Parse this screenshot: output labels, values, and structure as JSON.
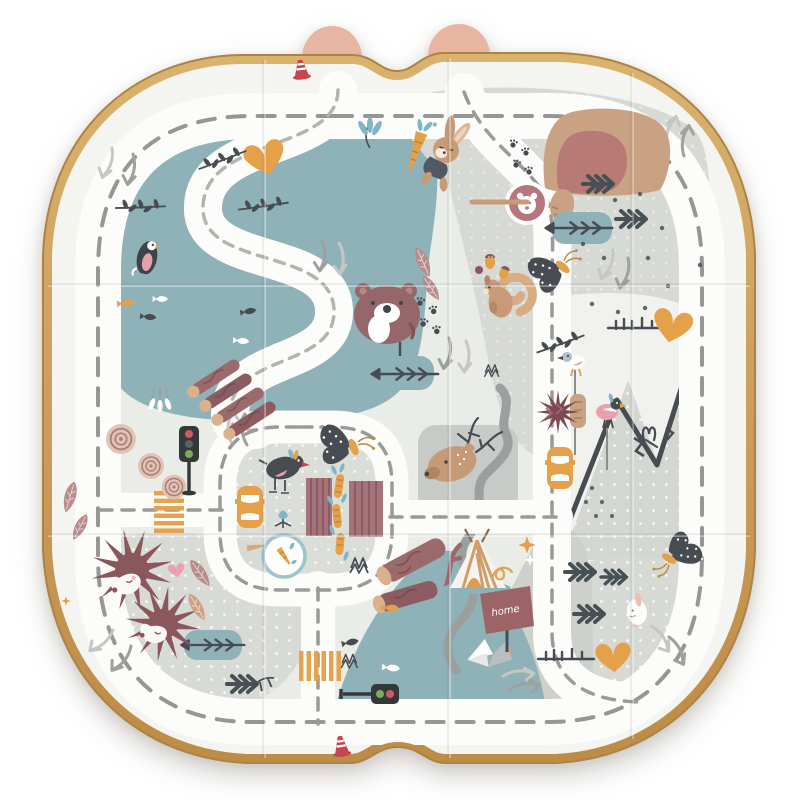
{
  "scene": {
    "type": "product-photo",
    "subject": "foldable children's play mat printed with a woodland road-map design",
    "background_color": "#ffffff"
  },
  "mat": {
    "border_color": "#c99e58",
    "surface_color": "#f4f5f1",
    "tab_color": "#e8b5a2",
    "tab_count": 2,
    "fold_creases": {
      "vertical_x": [
        262,
        447,
        630
      ],
      "horizontal_y": [
        283,
        533
      ]
    }
  },
  "signs": {
    "home_label": "home"
  },
  "palette": {
    "road_white": "#fcfcfa",
    "dash_gray": "#969795",
    "dash_light": "#b3b4b1",
    "ground": "#eaede7",
    "zone_gray": "#d7d9d5",
    "zone_gray_dark": "#c7cac6",
    "lake": "#8fb2b9",
    "charcoal": "#474c52",
    "maroon": "#9b6a6c",
    "berry": "#8a575c",
    "rose": "#b5767c",
    "pink": "#ec9fae",
    "orange": "#e5a04a",
    "tan": "#c89b76",
    "tan_light": "#d9b28c",
    "teal": "#7fb5c4",
    "red": "#c8444f",
    "river_gray": "#9aa09e",
    "arrow_light": "#c6c7c4"
  },
  "motifs": [
    {
      "name": "outer-ring-road",
      "count": 1
    },
    {
      "name": "s-curve-road",
      "count": 1
    },
    {
      "name": "village-loop-road",
      "count": 1
    },
    {
      "name": "lake",
      "count": 1
    },
    {
      "name": "pond",
      "count": 3
    },
    {
      "name": "blue-hill",
      "count": 1
    },
    {
      "name": "mountains",
      "count": 1
    },
    {
      "name": "river",
      "count": 1
    },
    {
      "name": "bear",
      "count": 1
    },
    {
      "name": "bear-den",
      "count": 1
    },
    {
      "name": "bunny-with-carrot",
      "count": 1
    },
    {
      "name": "white-bunny",
      "count": 1
    },
    {
      "name": "squirrel",
      "count": 1
    },
    {
      "name": "deer",
      "count": 1
    },
    {
      "name": "hedgehog",
      "count": 2
    },
    {
      "name": "crested-bird",
      "count": 3
    },
    {
      "name": "swimming-loon",
      "count": 1
    },
    {
      "name": "seagull",
      "count": 1
    },
    {
      "name": "moth",
      "count": 3
    },
    {
      "name": "paw-print-cluster",
      "count": 2
    },
    {
      "name": "paw-badge",
      "count": 1
    },
    {
      "name": "carrot-badge",
      "count": 1
    },
    {
      "name": "pine-tree",
      "count": 6
    },
    {
      "name": "stump-crown-tree",
      "count": 2
    },
    {
      "name": "tree-rings",
      "count": 3
    },
    {
      "name": "log-pile",
      "count": 2
    },
    {
      "name": "orange-heart",
      "count": 3
    },
    {
      "name": "pink-heart",
      "count": 1
    },
    {
      "name": "star",
      "count": 3
    },
    {
      "name": "tent",
      "count": 1
    },
    {
      "name": "home-sign",
      "count": 1
    },
    {
      "name": "traffic-light",
      "count": 2
    },
    {
      "name": "crosswalk",
      "count": 2
    },
    {
      "name": "toy-car",
      "count": 2
    },
    {
      "name": "traffic-cone",
      "count": 2
    },
    {
      "name": "fish",
      "count": 8
    },
    {
      "name": "feather",
      "count": 6
    },
    {
      "name": "twig-branch",
      "count": 7
    },
    {
      "name": "direction-arrow",
      "count": 18
    }
  ]
}
